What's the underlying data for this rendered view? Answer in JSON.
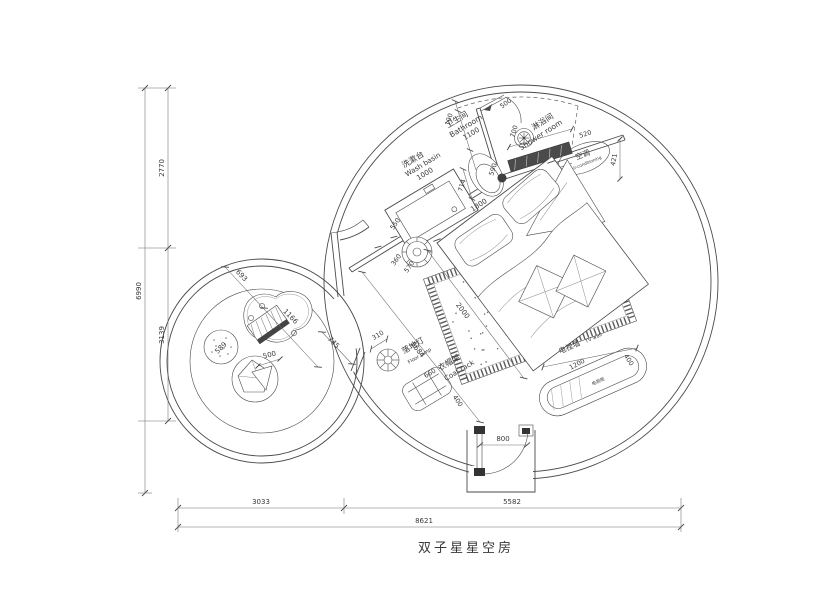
{
  "title": "双子星星空房",
  "labels": {
    "washbasin_cn": "洗漱台",
    "washbasin_en": "Wash basin",
    "bathroom_cn": "卫生间",
    "bathroom_en": "Bathroom",
    "shower_cn": "淋浴间",
    "shower_en": "Shower room",
    "ac_cn": "空调",
    "ac_en": "air-conditioning",
    "tv_wall_cn": "电视墙",
    "tv_wall_en": "TV wall",
    "tv_cabinet_cn": "电视柜",
    "coat_cn": "衣帽架",
    "coat_en": "Coat rack",
    "lamp_cn": "落地灯",
    "lamp_en": "Floor lamp"
  },
  "dims": {
    "overall_w": "8621",
    "w_left": "3033",
    "w_right": "5582",
    "overall_h": "6990",
    "h_top": "2770",
    "h_bottom": "3139",
    "washbasin": "1000",
    "washbasin_offset": "550",
    "bathroom": "1100",
    "wall_top": "190",
    "divider": "700",
    "bath_door": "500",
    "column": "590",
    "toilet_offset": "714",
    "bench": "520",
    "ac_clearance": "421",
    "bed_w": "1800",
    "bed_l": "2000",
    "room_diag": "5684",
    "stool_d": "360",
    "stool_c": "570",
    "tv_len": "1200",
    "tv_dep": "400",
    "lamp_d": "310",
    "coat_w": "660",
    "coat_d": "400",
    "entry_door": "800",
    "small_a": "693",
    "table_l": "1166",
    "passage": "745",
    "pouf_d": "589",
    "chair_d": "500"
  }
}
